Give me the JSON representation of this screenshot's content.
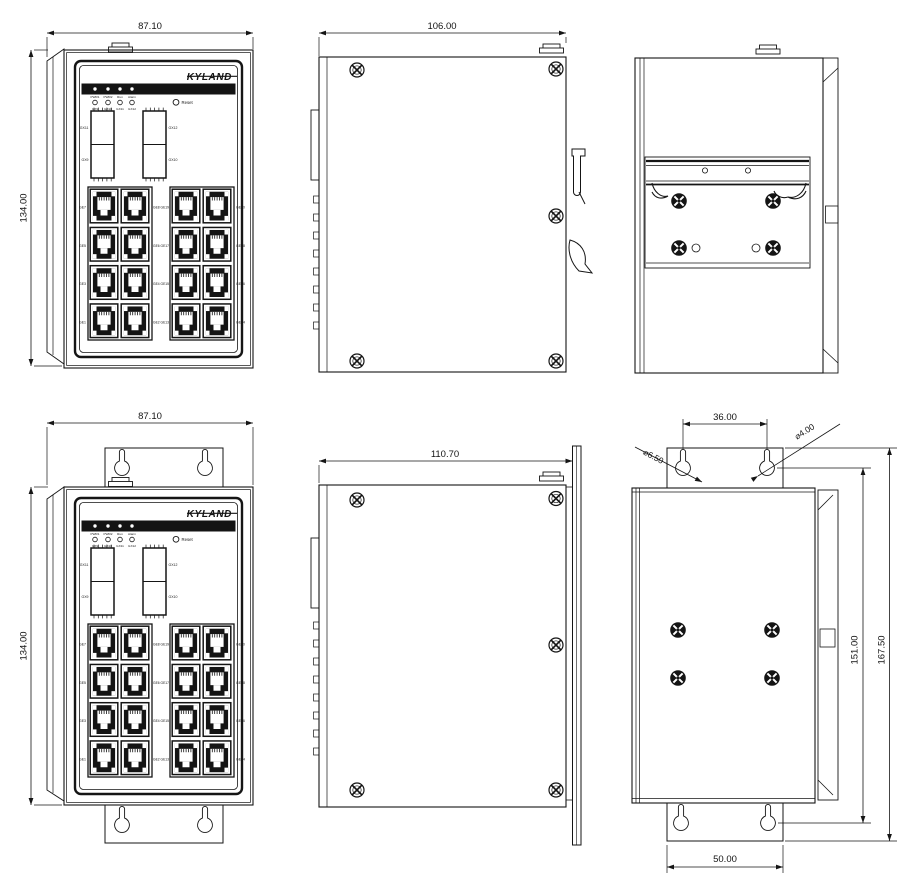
{
  "page": {
    "background": "#ffffff",
    "line_color": "#151515"
  },
  "device": {
    "brand": "KYLAND",
    "reset_label": "Reset",
    "led_status_labels": [
      "PWR1",
      "PWR2",
      "Run",
      "Alarm"
    ],
    "led_port_labels": [
      "GX9",
      "GX10",
      "GX11",
      "GX12"
    ],
    "sfp_labels": {
      "left_top": "GX11",
      "left_bottom": "GX9",
      "right_top": "GX12",
      "right_bottom": "GX10"
    },
    "rj45_left_labels": [
      "GE7",
      "GE5",
      "GE3",
      "GE1"
    ],
    "rj45_middle_labels": [
      "GE8 GE19",
      "GE6 GE17",
      "GE4 GE15",
      "GE2 GE13"
    ],
    "rj45_right_labels": [
      "GE20",
      "GE18",
      "GE16",
      "GE14"
    ]
  },
  "views": {
    "front_din": {
      "width_dim": "87.10",
      "height_dim": "134.00"
    },
    "side_din": {
      "depth_dim": "106.00"
    },
    "rear_din": {},
    "front_wall": {
      "width_dim": "87.10",
      "height_dim": "134.00"
    },
    "side_wall": {
      "depth_dim": "110.70"
    },
    "rear_wall": {
      "hole_spacing_top": "36.00",
      "hole_dia_large": "⌀6.50",
      "hole_dia_small": "⌀4.00",
      "height_inner": "151.00",
      "height_outer": "167.50",
      "hole_spacing_bottom": "50.00"
    }
  }
}
